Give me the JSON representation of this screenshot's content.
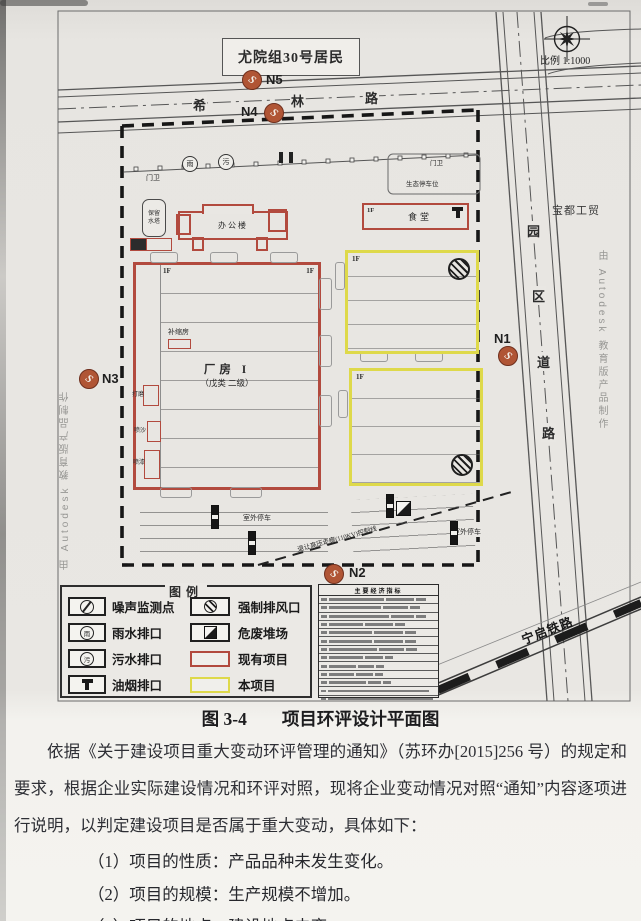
{
  "figure": {
    "scale_label": "比例 1:1000",
    "residents_label": "尤院组30号居民",
    "company_label": "宝都工贸",
    "railway_label": "宁启铁路",
    "watermark": "由 Autodesk 教育版产品制作",
    "road_top": {
      "chars": [
        "希",
        "林",
        "路"
      ]
    },
    "road_right": {
      "chars": [
        "园",
        "区",
        "道",
        "路"
      ]
    },
    "markers": {
      "n1": "N1",
      "n2": "N2",
      "n3": "N3",
      "n4": "N4",
      "n5": "N5"
    },
    "site": {
      "gate_label": "门卫",
      "eco_parking_label": "生态停车位",
      "water_tower_label": "保留水塔",
      "office_label": "办公楼",
      "canteen_label": "食堂",
      "floor_label": "1F",
      "workshop_title": "厂房 I",
      "workshop_class": "（戊类 二级）",
      "riser_room_label": "补缩房",
      "room_labels": [
        "打磨",
        "喷沙",
        "喷漆"
      ],
      "outdoor_parking_label": "室外停车",
      "hv_corridor_label": "退让高压走廊(110KV)控制线",
      "rain_char": "雨",
      "sewage_char": "污"
    },
    "legend": {
      "title": "图例",
      "items": [
        {
          "label": "噪声监测点"
        },
        {
          "label": "雨水排口"
        },
        {
          "label": "污水排口"
        },
        {
          "label": "油烟排口"
        },
        {
          "label": "强制排风口"
        },
        {
          "label": "危废堆场"
        },
        {
          "label": "现有项目"
        },
        {
          "label": "本项目"
        }
      ]
    },
    "indicator_table": {
      "title": "主要经济指标"
    },
    "colors": {
      "existing": "#b24a3e",
      "new_project": "#ded94a",
      "marker": "#b05535"
    }
  },
  "caption": "图 3-4　　项目环评设计平面图",
  "body": {
    "paragraph": "依据《关于建设项目重大变动环评管理的通知》（苏环办[2015]256 号）的规定和要求，根据企业实际建设情况和环评对照，现将企业变动情况对照“通知”内容逐项进行说明，以判定建设项目是否属于重大变动，具体如下：",
    "items": [
      "（1）项目的性质：产品品种未发生变化。",
      "（2）项目的规模：生产规模不增加。",
      "（3）项目的地点：建设地点未变。"
    ]
  }
}
